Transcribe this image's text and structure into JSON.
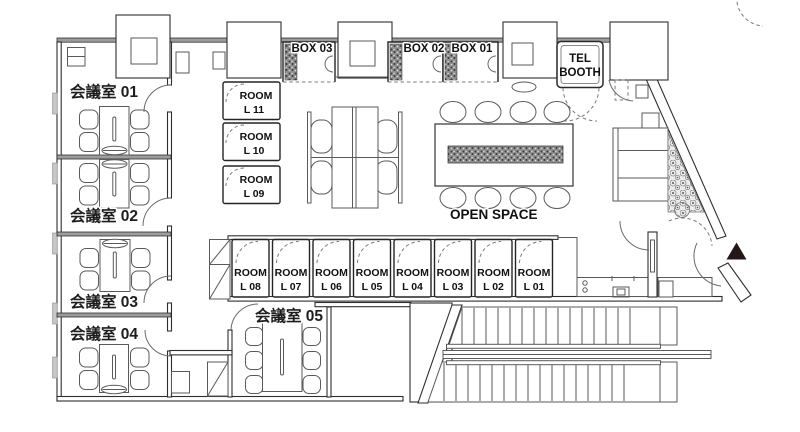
{
  "plan": {
    "meeting_rooms": [
      {
        "label": "会議室 01"
      },
      {
        "label": "会議室 02"
      },
      {
        "label": "会議室 03"
      },
      {
        "label": "会議室 04"
      },
      {
        "label": "会議室 05"
      }
    ],
    "phone_boxes": [
      {
        "label": "BOX 03"
      },
      {
        "label": "BOX 02"
      },
      {
        "label": "BOX 01"
      }
    ],
    "tel_booth": {
      "line1": "TEL",
      "line2": "BOOTH"
    },
    "open_space": {
      "label": "OPEN SPACE"
    },
    "rooms_left": [
      {
        "name": "ROOM",
        "code": "L 11"
      },
      {
        "name": "ROOM",
        "code": "L 10"
      },
      {
        "name": "ROOM",
        "code": "L 09"
      }
    ],
    "rooms_row": [
      {
        "name": "ROOM",
        "code": "L 08"
      },
      {
        "name": "ROOM",
        "code": "L 07"
      },
      {
        "name": "ROOM",
        "code": "L 06"
      },
      {
        "name": "ROOM",
        "code": "L 05"
      },
      {
        "name": "ROOM",
        "code": "L 04"
      },
      {
        "name": "ROOM",
        "code": "L 03"
      },
      {
        "name": "ROOM",
        "code": "L 02"
      },
      {
        "name": "ROOM",
        "code": "L 01"
      }
    ],
    "colors": {
      "wall_fill": "#9c9c9c",
      "line": "#2e2e2e",
      "entrance_marker": "#231815"
    }
  }
}
